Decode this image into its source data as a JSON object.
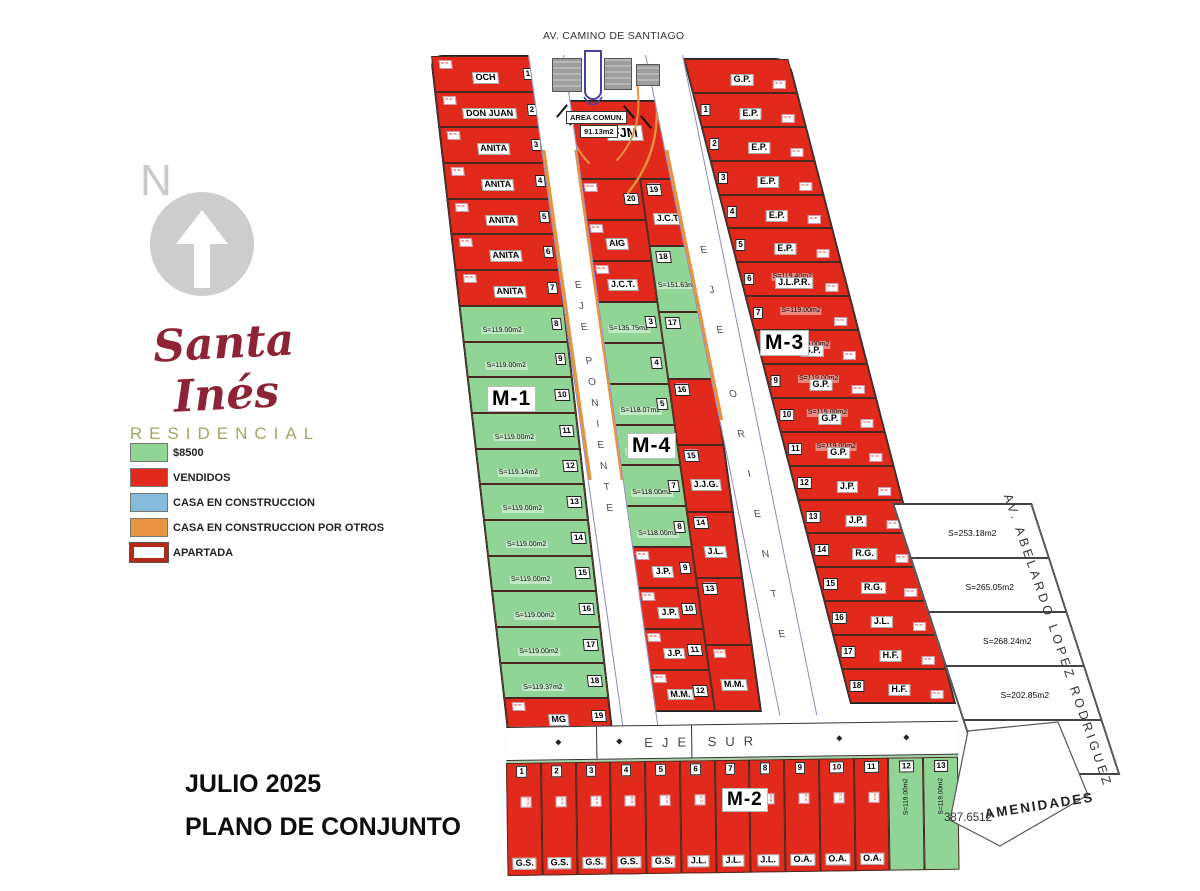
{
  "north": {
    "label": "N"
  },
  "logo": {
    "name": "Santa Inés",
    "subtitle": "RESIDENCIAL"
  },
  "legend": [
    {
      "label": "$8500",
      "color": "#90d595",
      "type": "fill"
    },
    {
      "label": "VENDIDOS",
      "color": "#e1291c",
      "type": "fill"
    },
    {
      "label": "CASA EN CONSTRUCCION",
      "color": "#85bada",
      "type": "fill"
    },
    {
      "label": "CASA EN CONSTRUCCION POR OTROS",
      "color": "#e99440",
      "type": "fill"
    },
    {
      "label": "APARTADA",
      "color": "#b5291a",
      "type": "outline"
    }
  ],
  "footer": {
    "date": "JULIO 2025",
    "title": "PLANO DE CONJUNTO"
  },
  "streets": {
    "top": "AV. CAMINO DE SANTIAGO",
    "west": "EJE PONIENTE",
    "east": "EJE ORIENTE",
    "south": "EJE SUR",
    "avenue": "AV.  ABELARDO  LOPEZ  RODRIGUEZ"
  },
  "area_comun": {
    "line1": "AREA COMUN.",
    "line2": "91.13m2"
  },
  "amenities": {
    "label": "AMENIDADES",
    "ref": "387.6512"
  },
  "glyphs": {
    "diamond": "◆",
    "squiggle": "≈≈"
  },
  "blocks": {
    "m1": {
      "label": "M-1",
      "lots": [
        {
          "n": "1",
          "o": "OCH",
          "s": "sold"
        },
        {
          "n": "2",
          "o": "DON JUAN",
          "s": "sold"
        },
        {
          "n": "3",
          "o": "ANITA",
          "s": "sold"
        },
        {
          "n": "4",
          "o": "ANITA",
          "s": "sold"
        },
        {
          "n": "5",
          "o": "ANITA",
          "s": "sold"
        },
        {
          "n": "6",
          "o": "ANITA",
          "s": "sold"
        },
        {
          "n": "7",
          "o": "ANITA",
          "s": "sold"
        },
        {
          "n": "8",
          "a": "S=119.00m2",
          "s": "available"
        },
        {
          "n": "9",
          "a": "S=119.00m2",
          "s": "available"
        },
        {
          "n": "10",
          "a": "S=119.00m2",
          "s": "available"
        },
        {
          "n": "11",
          "a": "S=119.00m2",
          "s": "available"
        },
        {
          "n": "12",
          "a": "S=119.14m2",
          "s": "available"
        },
        {
          "n": "13",
          "a": "S=119.00m2",
          "s": "available"
        },
        {
          "n": "14",
          "a": "S=119.00m2",
          "s": "available"
        },
        {
          "n": "15",
          "a": "S=119.00m2",
          "s": "available"
        },
        {
          "n": "16",
          "a": "S=119.00m2",
          "s": "available"
        },
        {
          "n": "17",
          "a": "S=119.00m2",
          "s": "available"
        },
        {
          "n": "18",
          "a": "S=119.37m2",
          "s": "available"
        },
        {
          "n": "19",
          "o": "MG",
          "s": "sold"
        }
      ]
    },
    "m4": {
      "label": "M-4",
      "top": {
        "o": "FJM",
        "s": "sold"
      },
      "left": [
        {
          "n": "20",
          "s": "sold"
        },
        {
          "o": "AIG",
          "s": "sold"
        },
        {
          "o": "J.C.T.",
          "s": "sold"
        },
        {
          "n": "3",
          "a": "S=135.75m2",
          "s": "available"
        },
        {
          "n": "4",
          "s": "available"
        },
        {
          "n": "5",
          "a": "S=118.07m2",
          "s": "available"
        },
        {
          "n": "6",
          "a": "S=118.00m2",
          "s": "available"
        },
        {
          "n": "7",
          "a": "S=118.00m2",
          "s": "available"
        },
        {
          "n": "8",
          "a": "S=118.00m2",
          "s": "available"
        },
        {
          "n": "9",
          "o": "J.P.",
          "s": "sold"
        },
        {
          "n": "10",
          "o": "J.P.",
          "s": "sold"
        },
        {
          "n": "11",
          "o": "J.P.",
          "s": "sold"
        },
        {
          "n": "12",
          "o": "M.M.",
          "s": "sold"
        }
      ],
      "right": [
        {
          "n": "19",
          "o": "J.C.T.",
          "s": "sold"
        },
        {
          "n": "18",
          "a": "S=151.63m2",
          "s": "available"
        },
        {
          "n": "17",
          "s": "available"
        },
        {
          "n": "16",
          "s": "sold"
        },
        {
          "n": "15",
          "o": "J.J.G.",
          "s": "sold"
        },
        {
          "n": "14",
          "o": "J.L.",
          "s": "sold"
        },
        {
          "n": "13",
          "s": "sold"
        },
        {
          "o": "M.M.",
          "s": "sold"
        }
      ]
    },
    "m3": {
      "label": "M-3",
      "lots": [
        {
          "o": "G.P.",
          "s": "sold"
        },
        {
          "n": "1",
          "o": "E.P.",
          "s": "sold"
        },
        {
          "n": "2",
          "o": "E.P.",
          "s": "sold"
        },
        {
          "n": "3",
          "o": "E.P.",
          "s": "sold"
        },
        {
          "n": "4",
          "o": "E.P.",
          "s": "sold"
        },
        {
          "n": "5",
          "o": "E.P.",
          "s": "sold"
        },
        {
          "n": "6",
          "o": "J.L.P.R.",
          "a": "S=119.40m2",
          "s": "sold"
        },
        {
          "n": "7",
          "a": "S=119.00m2",
          "s": "sold"
        },
        {
          "n": "8",
          "o": "G.P.",
          "a": "S=119.00m2",
          "s": "sold"
        },
        {
          "n": "9",
          "o": "G.P.",
          "a": "S=119.00m2",
          "s": "sold"
        },
        {
          "n": "10",
          "o": "G.P.",
          "a": "S=119.00m2",
          "s": "sold"
        },
        {
          "n": "11",
          "o": "G.P.",
          "a": "S=119.00m2",
          "s": "sold"
        },
        {
          "n": "12",
          "o": "J.P.",
          "s": "sold"
        },
        {
          "n": "13",
          "o": "J.P.",
          "s": "sold"
        },
        {
          "n": "14",
          "o": "R.G.",
          "s": "sold"
        },
        {
          "n": "15",
          "o": "R.G.",
          "s": "sold"
        },
        {
          "n": "16",
          "o": "J.L.",
          "s": "sold"
        },
        {
          "n": "17",
          "o": "H.F.",
          "s": "sold"
        },
        {
          "n": "18",
          "o": "H.F.",
          "s": "sold"
        }
      ]
    },
    "m2": {
      "label": "M-2",
      "lots": [
        {
          "n": "1",
          "o": "G.S.",
          "s": "sold"
        },
        {
          "n": "2",
          "o": "G.S.",
          "s": "sold"
        },
        {
          "n": "3",
          "o": "G.S.",
          "s": "sold"
        },
        {
          "n": "4",
          "o": "G.S.",
          "s": "sold"
        },
        {
          "n": "5",
          "o": "G.S.",
          "s": "sold"
        },
        {
          "n": "6",
          "o": "J.L.",
          "s": "sold"
        },
        {
          "n": "7",
          "o": "J.L.",
          "s": "sold"
        },
        {
          "n": "8",
          "o": "J.L.",
          "s": "sold"
        },
        {
          "n": "9",
          "o": "O.A.",
          "s": "sold"
        },
        {
          "n": "10",
          "o": "O.A.",
          "s": "sold"
        },
        {
          "n": "11",
          "o": "O.A.",
          "s": "sold"
        },
        {
          "n": "12",
          "a": "S=119.00m2",
          "s": "available"
        },
        {
          "n": "13",
          "a": "S=119.00m2",
          "s": "available"
        }
      ]
    },
    "east": {
      "lots": [
        {
          "a": "S=253.18m2"
        },
        {
          "a": "S=265.05m2"
        },
        {
          "a": "S=268.24m2"
        },
        {
          "a": "S=202.85m2"
        },
        {
          "a": "S=203.49m2"
        }
      ]
    }
  }
}
